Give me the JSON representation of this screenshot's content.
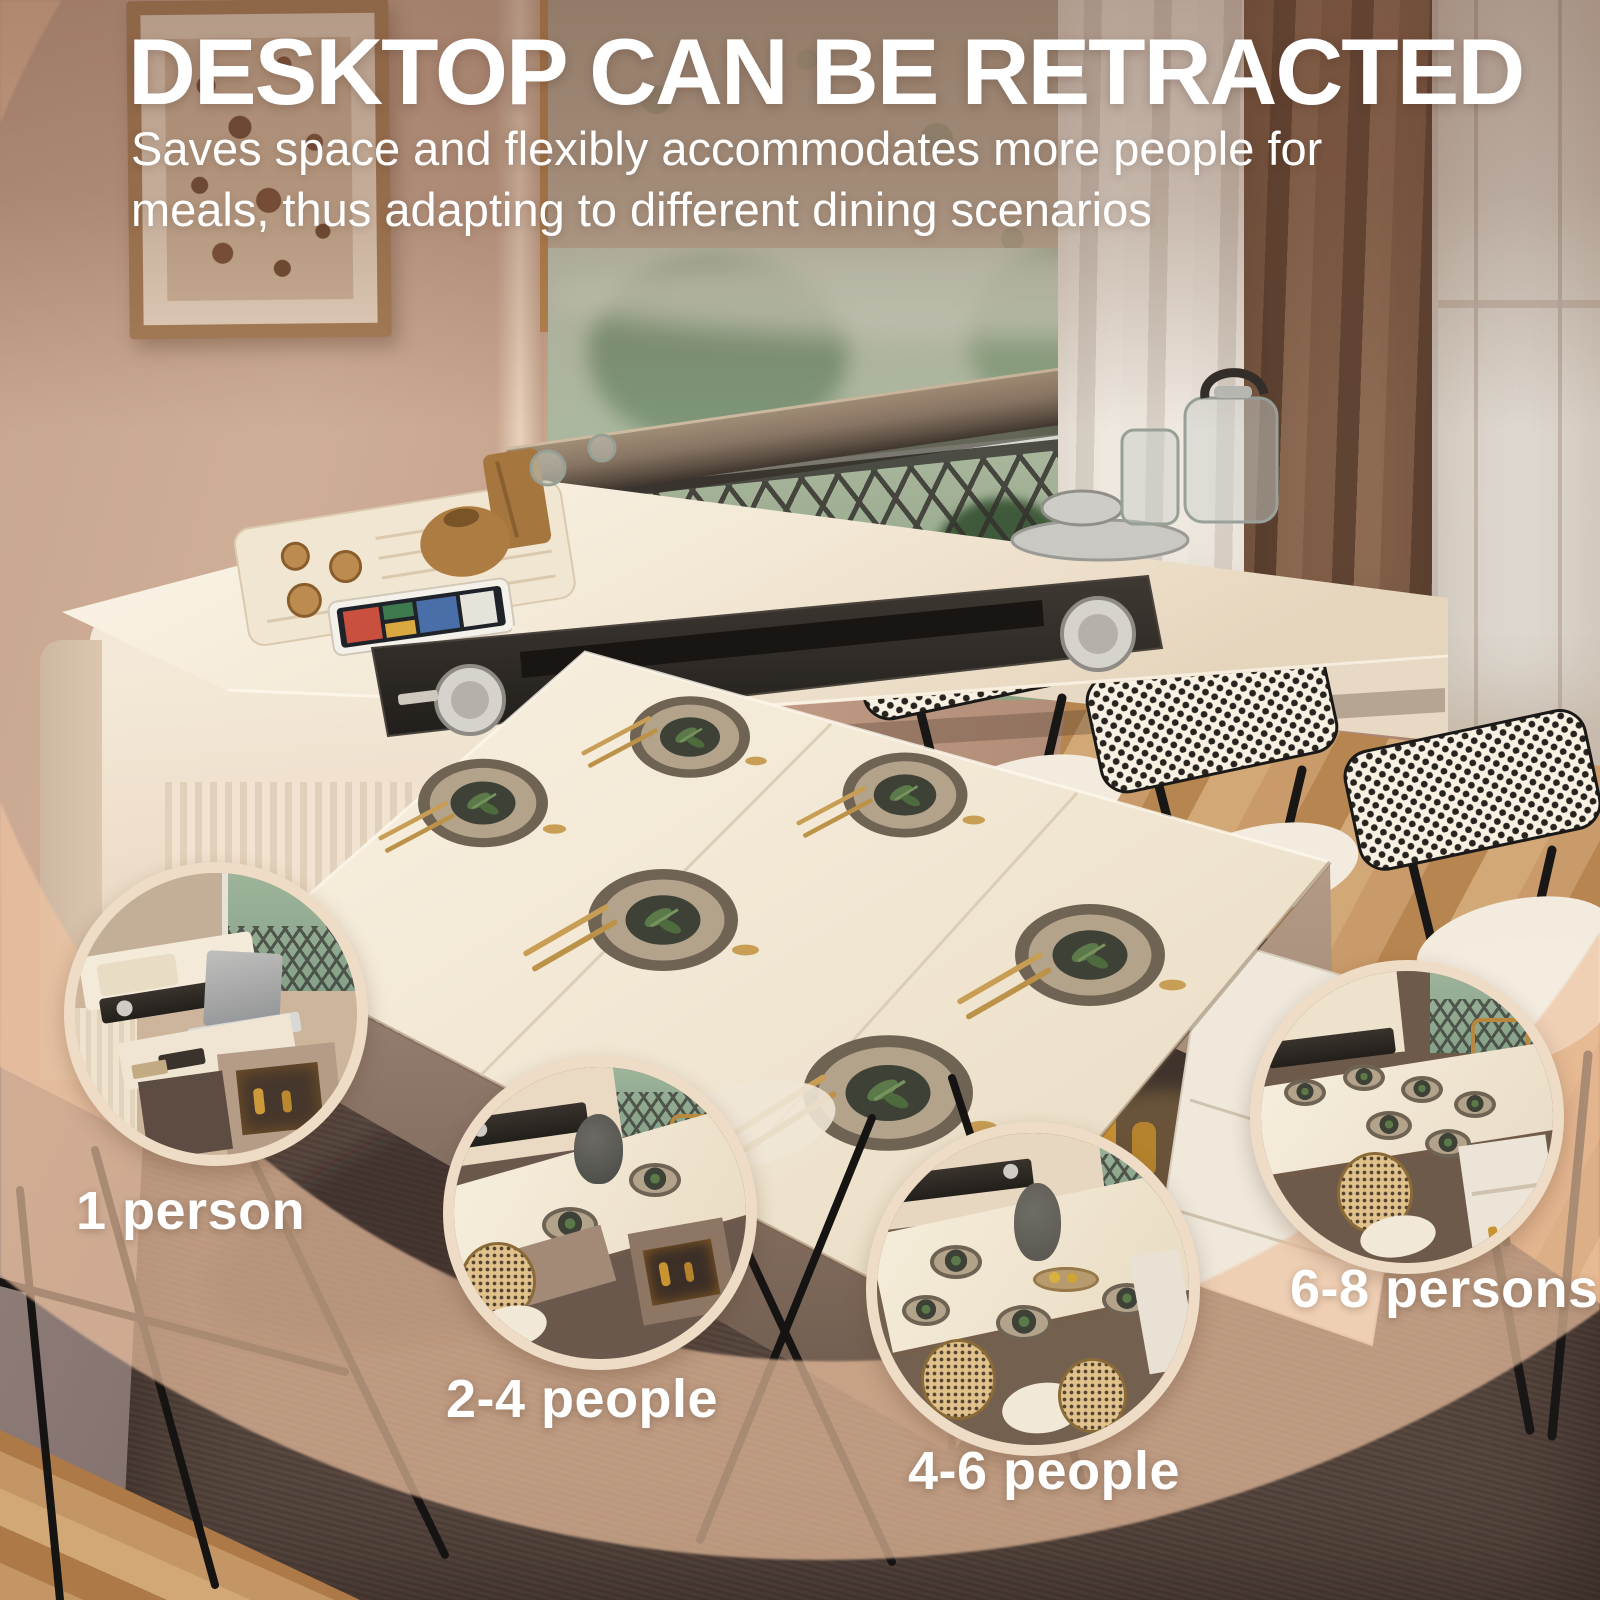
{
  "header": {
    "title": "DESKTOP CAN BE RETRACTED",
    "subtitle_line1": "Saves space and flexibly accommodates more people for",
    "subtitle_line2": "meals, thus adapting to different dining scenarios"
  },
  "scenarios": [
    {
      "id": "one-person",
      "label": "1 person"
    },
    {
      "id": "two-four",
      "label": "2-4 people"
    },
    {
      "id": "four-six",
      "label": "4-6 people"
    },
    {
      "id": "six-eight",
      "label": "6-8 persons"
    }
  ],
  "colors": {
    "text": "#ffffff",
    "swoosh_overlay": "#efc3a0",
    "circle_ring": "#eedcc6",
    "table_top": "#f4ead9",
    "wall": "#bb9681",
    "plate_center": "#3e4136",
    "gold_cutlery": "#c79e54"
  }
}
